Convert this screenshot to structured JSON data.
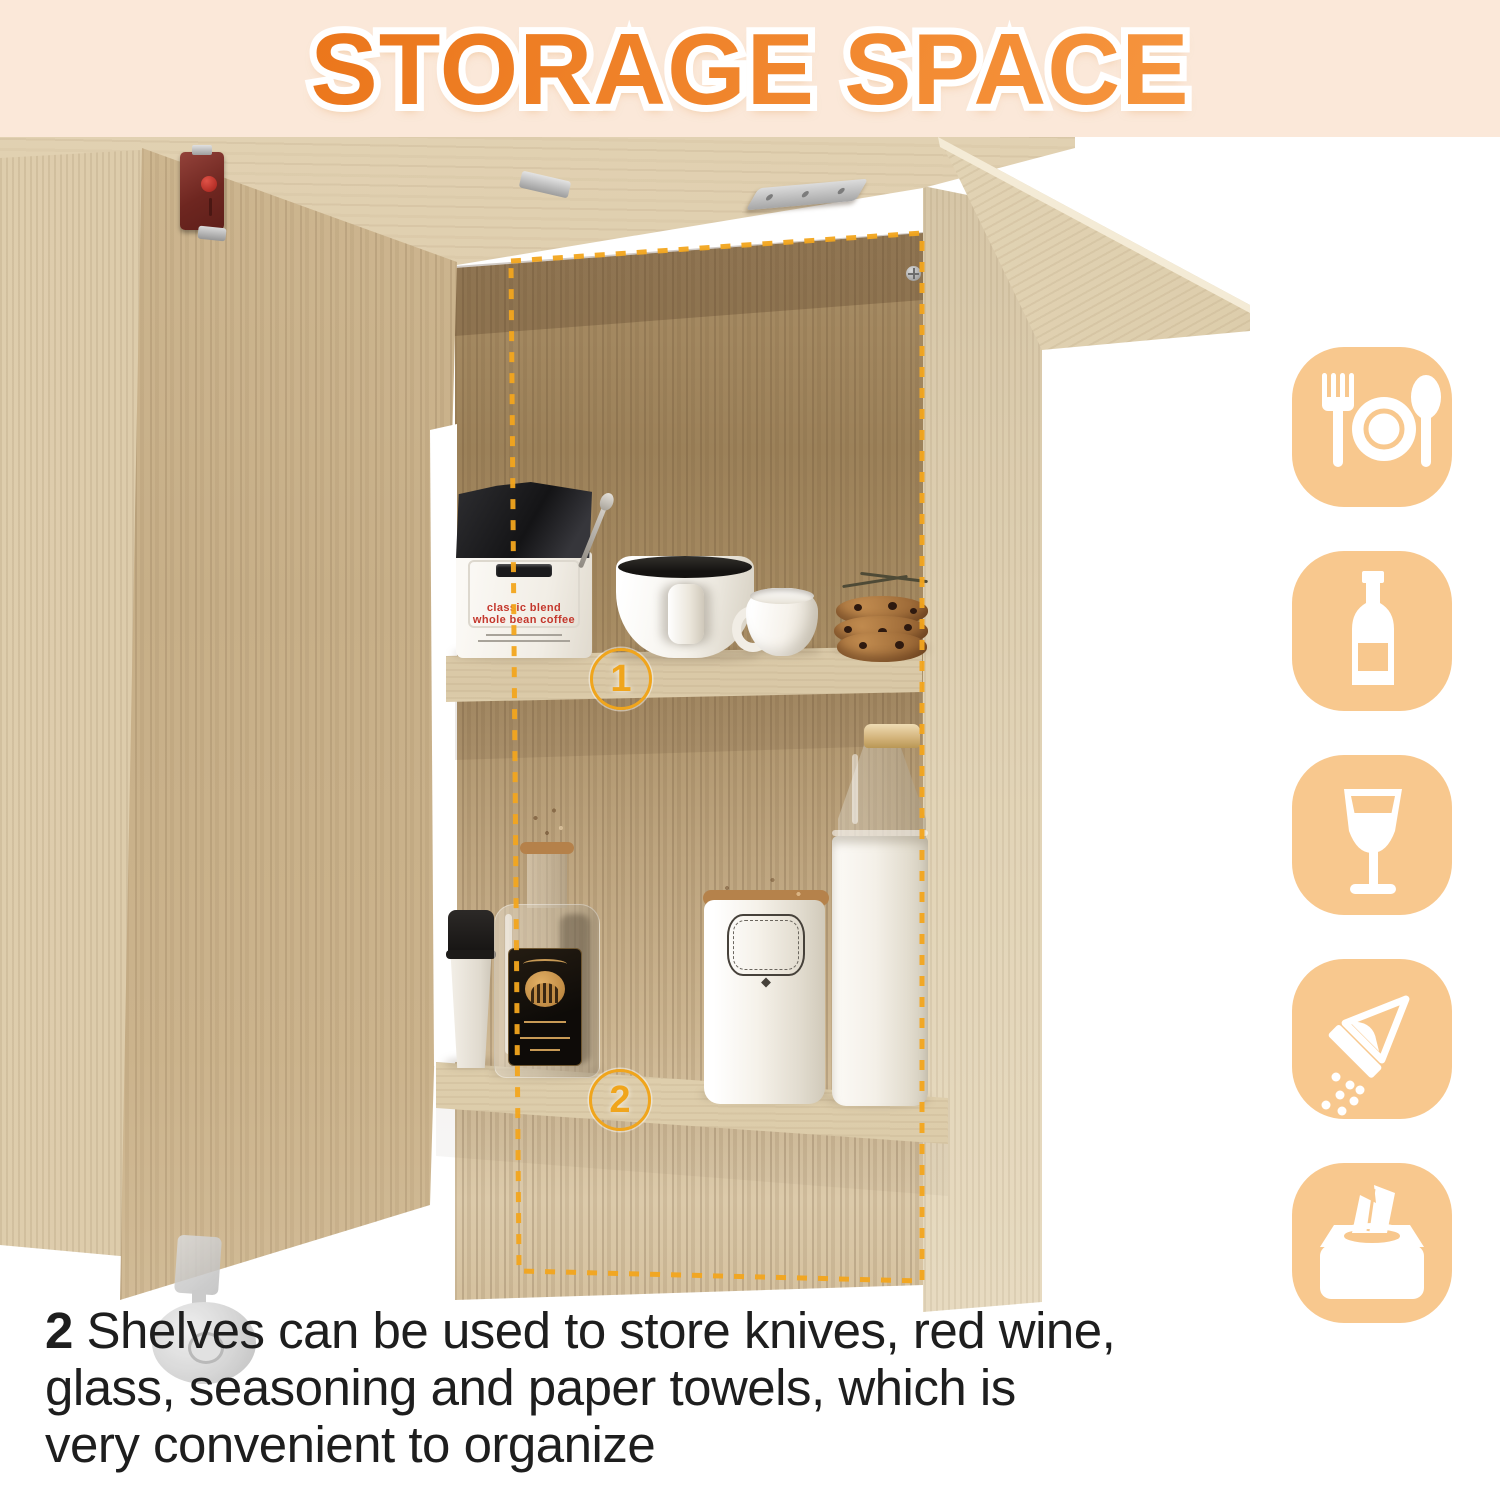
{
  "header": {
    "title": "STORAGE SPACE"
  },
  "annotations": {
    "shelf1_label": "1",
    "shelf2_label": "2"
  },
  "coffee_bag": {
    "line1": "classic blend",
    "line2": "whole bean coffee"
  },
  "side_icons": [
    {
      "name": "tableware"
    },
    {
      "name": "wine-bottle"
    },
    {
      "name": "wine-glass"
    },
    {
      "name": "seasoning-shaker"
    },
    {
      "name": "tissue-box"
    }
  ],
  "caption": {
    "lines": [
      "2 Shelves can be used to store knives, red wine,",
      "glass, seasoning and paper towels, which is",
      "very convenient to organize"
    ]
  },
  "colors": {
    "band_bg": "#FBE8D9",
    "title_orange": "#F0802A",
    "dash_gold": "#F2A51D",
    "icon_bg": "#F8C88E"
  }
}
